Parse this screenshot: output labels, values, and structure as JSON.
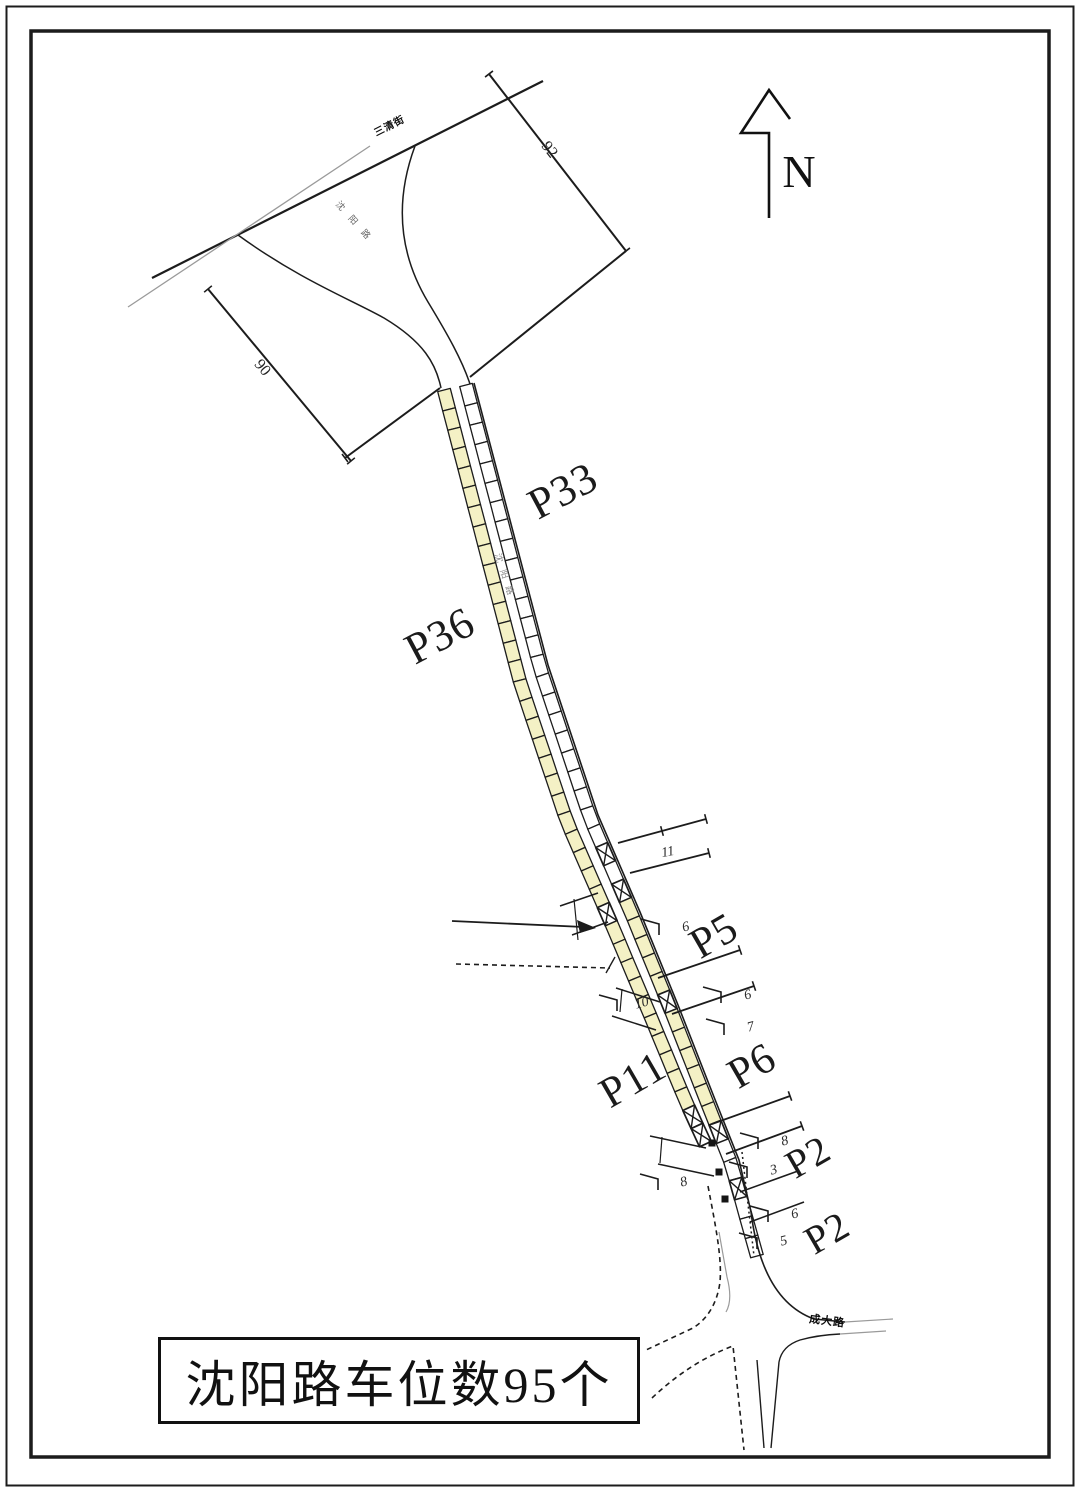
{
  "drawing": {
    "title_box_text": "沈阳路车位数95个",
    "north_label": "N"
  },
  "road_names": {
    "cross_top": "三清街",
    "main_top_curve": "沈阳路",
    "main_mid": "沈阳路",
    "cross_bottom": "成大路"
  },
  "boundary_dimensions": {
    "east_side": "92",
    "west_side": "90"
  },
  "parking": {
    "road": "沈阳路",
    "total_spaces": 95,
    "groups": [
      {
        "label": "P33",
        "spaces": 33,
        "side": "east"
      },
      {
        "label": "P36",
        "spaces": 36,
        "side": "west"
      },
      {
        "label": "P5",
        "spaces": 5,
        "side": "east"
      },
      {
        "label": "P6",
        "spaces": 6,
        "side": "east"
      },
      {
        "label": "P11",
        "spaces": 11,
        "side": "west"
      },
      {
        "label": "P2",
        "spaces": 2,
        "side": "east"
      },
      {
        "label": "P2",
        "spaces": 2,
        "side": "east"
      }
    ]
  },
  "callouts": [
    "11",
    "6",
    "6",
    "7",
    "8",
    "3",
    "6",
    "5",
    "10",
    "8"
  ],
  "colors": {
    "stall_fill_yellow": "#f4f1c5",
    "stall_fill_white": "#ffffff",
    "line": "#1c1c1c",
    "faint_line": "#9a9a9a"
  }
}
